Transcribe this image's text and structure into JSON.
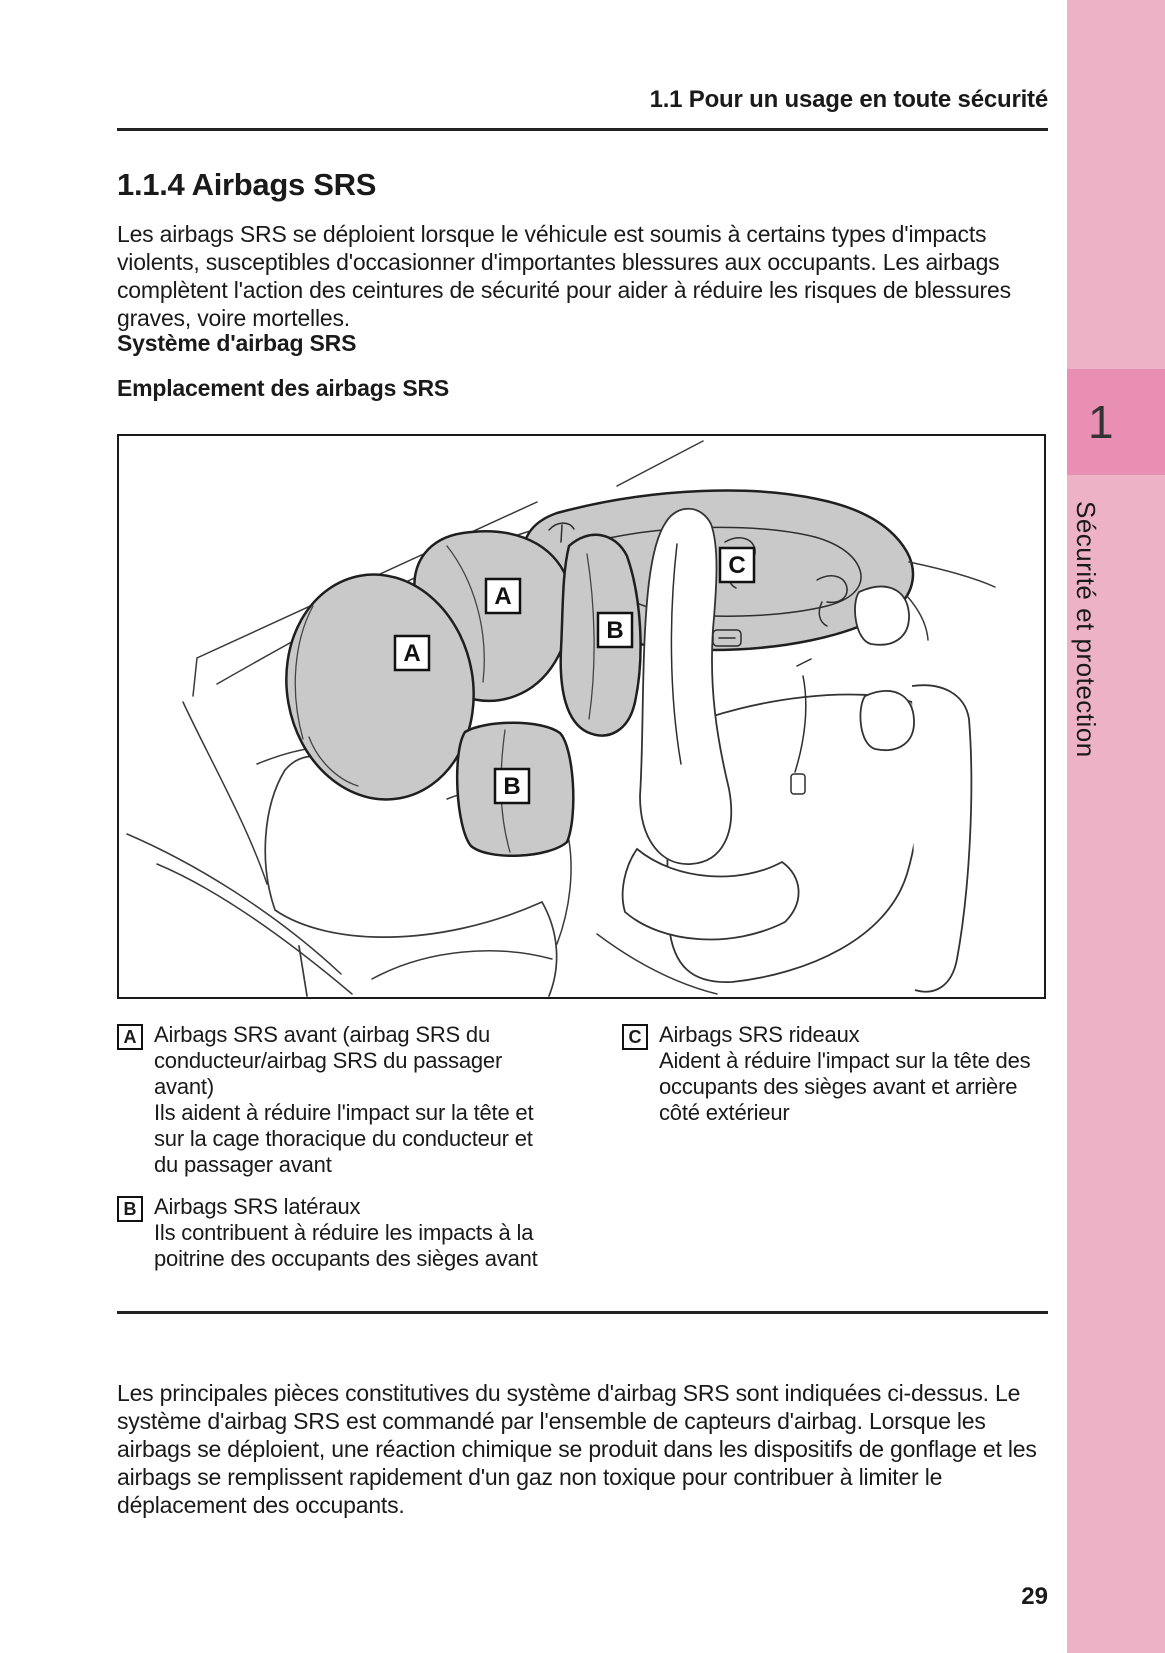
{
  "page": {
    "header": "1.1  Pour un usage en toute sécurité",
    "section_title": "1.1.4  Airbags SRS",
    "intro": "Les airbags SRS se déploient lorsque le véhicule est soumis à certains types d'impacts violents, susceptibles d'occasionner d'importantes blessures aux occupants. Les airbags complètent l'action des ceintures de sécurité pour aider à réduire les risques de blessures graves, voire mortelles.",
    "subheading_1": "Système d'airbag SRS",
    "subheading_2": "Emplacement des airbags SRS",
    "closing": "Les principales pièces constitutives du système d'airbag SRS sont indiquées ci-dessus. Le système d'airbag SRS est commandé par l'ensemble de capteurs d'airbag. Lorsque les airbags se déploient, une réaction chimique se produit dans les dispositifs de gonflage et les airbags se remplissent rapidement d'un gaz non toxique pour contribuer à limiter le déplacement des occupants.",
    "page_number": "29"
  },
  "sidebar": {
    "chapter_number": "1",
    "chapter_title": "Sécurité et protection",
    "strip_color": "#eeb2c6",
    "tab_color": "#e98fb3"
  },
  "figure": {
    "airbag_fill": "#c9c9c9",
    "labels": [
      {
        "letter": "A"
      },
      {
        "letter": "A"
      },
      {
        "letter": "B"
      },
      {
        "letter": "B"
      },
      {
        "letter": "C"
      }
    ]
  },
  "legend": {
    "items": [
      {
        "marker": "A",
        "title": "Airbags SRS avant (airbag SRS du conducteur/airbag SRS du passager avant)",
        "description": "Ils aident à réduire l'impact sur la tête et sur la cage thoracique du conducteur et du passager avant"
      },
      {
        "marker": "B",
        "title": "Airbags SRS latéraux",
        "description": "Ils contribuent à réduire les impacts à la poitrine des occupants des sièges avant"
      },
      {
        "marker": "C",
        "title": "Airbags SRS rideaux",
        "description": "Aident à réduire l'impact sur la tête des occupants des sièges avant et arrière côté extérieur"
      }
    ]
  }
}
